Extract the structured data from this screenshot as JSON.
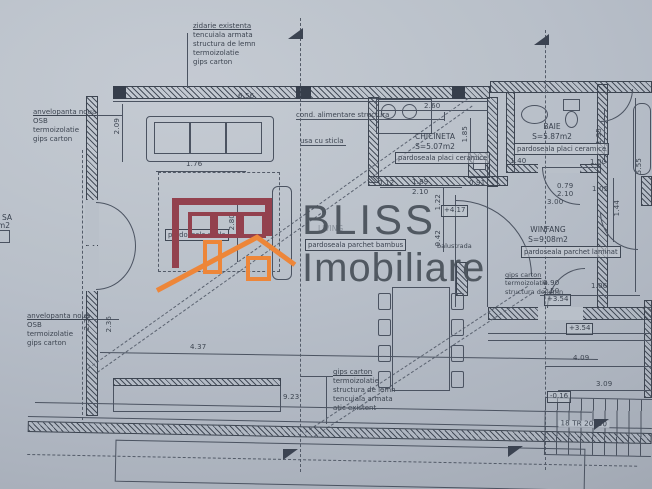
{
  "colors": {
    "paper": "#bac1cb",
    "ink": "#454d59",
    "brand_maroon": "#93404d",
    "brand_orange": "#ef8638"
  },
  "watermark": {
    "brand_top": "BLISS",
    "brand_bottom": "Imobiliare"
  },
  "notes": {
    "top_wall": [
      "zidarie existenta",
      "tencuiala armata",
      "structura de lemn",
      "termoizolatie",
      "gips carton"
    ],
    "left_upper": [
      "anvelopanta noua",
      "OSB",
      "termoizolatie",
      "gips carton"
    ],
    "left_lower": [
      "anvelopanta noua",
      "OSB",
      "termoizolatie",
      "gips carton"
    ],
    "bottom_wall": [
      "gips carton",
      "termoizolatie",
      "structura de lemn",
      "tencuiala armata",
      "atic existent"
    ],
    "right_mid": [
      "gips carton",
      "termoizolatie",
      "structura de lemn"
    ],
    "duct": "cond. alimentare structura",
    "glass_door": "usa cu sticla"
  },
  "rooms": {
    "living": {
      "name": "LIVING",
      "floor": "pardoseala parchet bambus"
    },
    "chicineta": {
      "name": "CHICINETA",
      "area": "S=5.07m2",
      "floor": "pardoseala placi ceramice"
    },
    "baie": {
      "name": "BAIE",
      "area": "S=5.87m2",
      "floor": "pardoseala placi ceramice"
    },
    "winfang": {
      "name": "WINFANG",
      "area": "S=9.08m2",
      "floor": "pardoseala parchet laminat"
    },
    "left_partial": {
      "name": "SA",
      "area": "7m2"
    },
    "rug_label": "pardoseala sticla",
    "balustrada": "balustrada",
    "stairs": "18 TR 20x30"
  },
  "levels": {
    "l417": "+4.17",
    "l354a": "+3.54",
    "l354b": "+3.54",
    "l016": "-0.16"
  },
  "dims": {
    "d656": "6.56",
    "d260": "2.60",
    "d176": "1.76",
    "d437": "4.37",
    "d923": "9.23",
    "d189": "1.89",
    "d210a": "2.10",
    "d012": "0.12",
    "d091": "0.91",
    "d140": "1.40",
    "d100": "1.00",
    "d079": "0.79",
    "d210b": "2.10",
    "d300": "3.00",
    "d105": "1.05",
    "d090": "0.90",
    "d250": "2.50",
    "d106": "1.06",
    "d409": "4.09",
    "d309": "3.09",
    "d209": "2.09",
    "d280": "2.80",
    "d185": "1.85",
    "d195": "1.95",
    "d555": "5.55",
    "d144": "1.44",
    "d230": "2.30",
    "d236": "2.36",
    "d122": "1.22",
    "d042": "0.42"
  }
}
